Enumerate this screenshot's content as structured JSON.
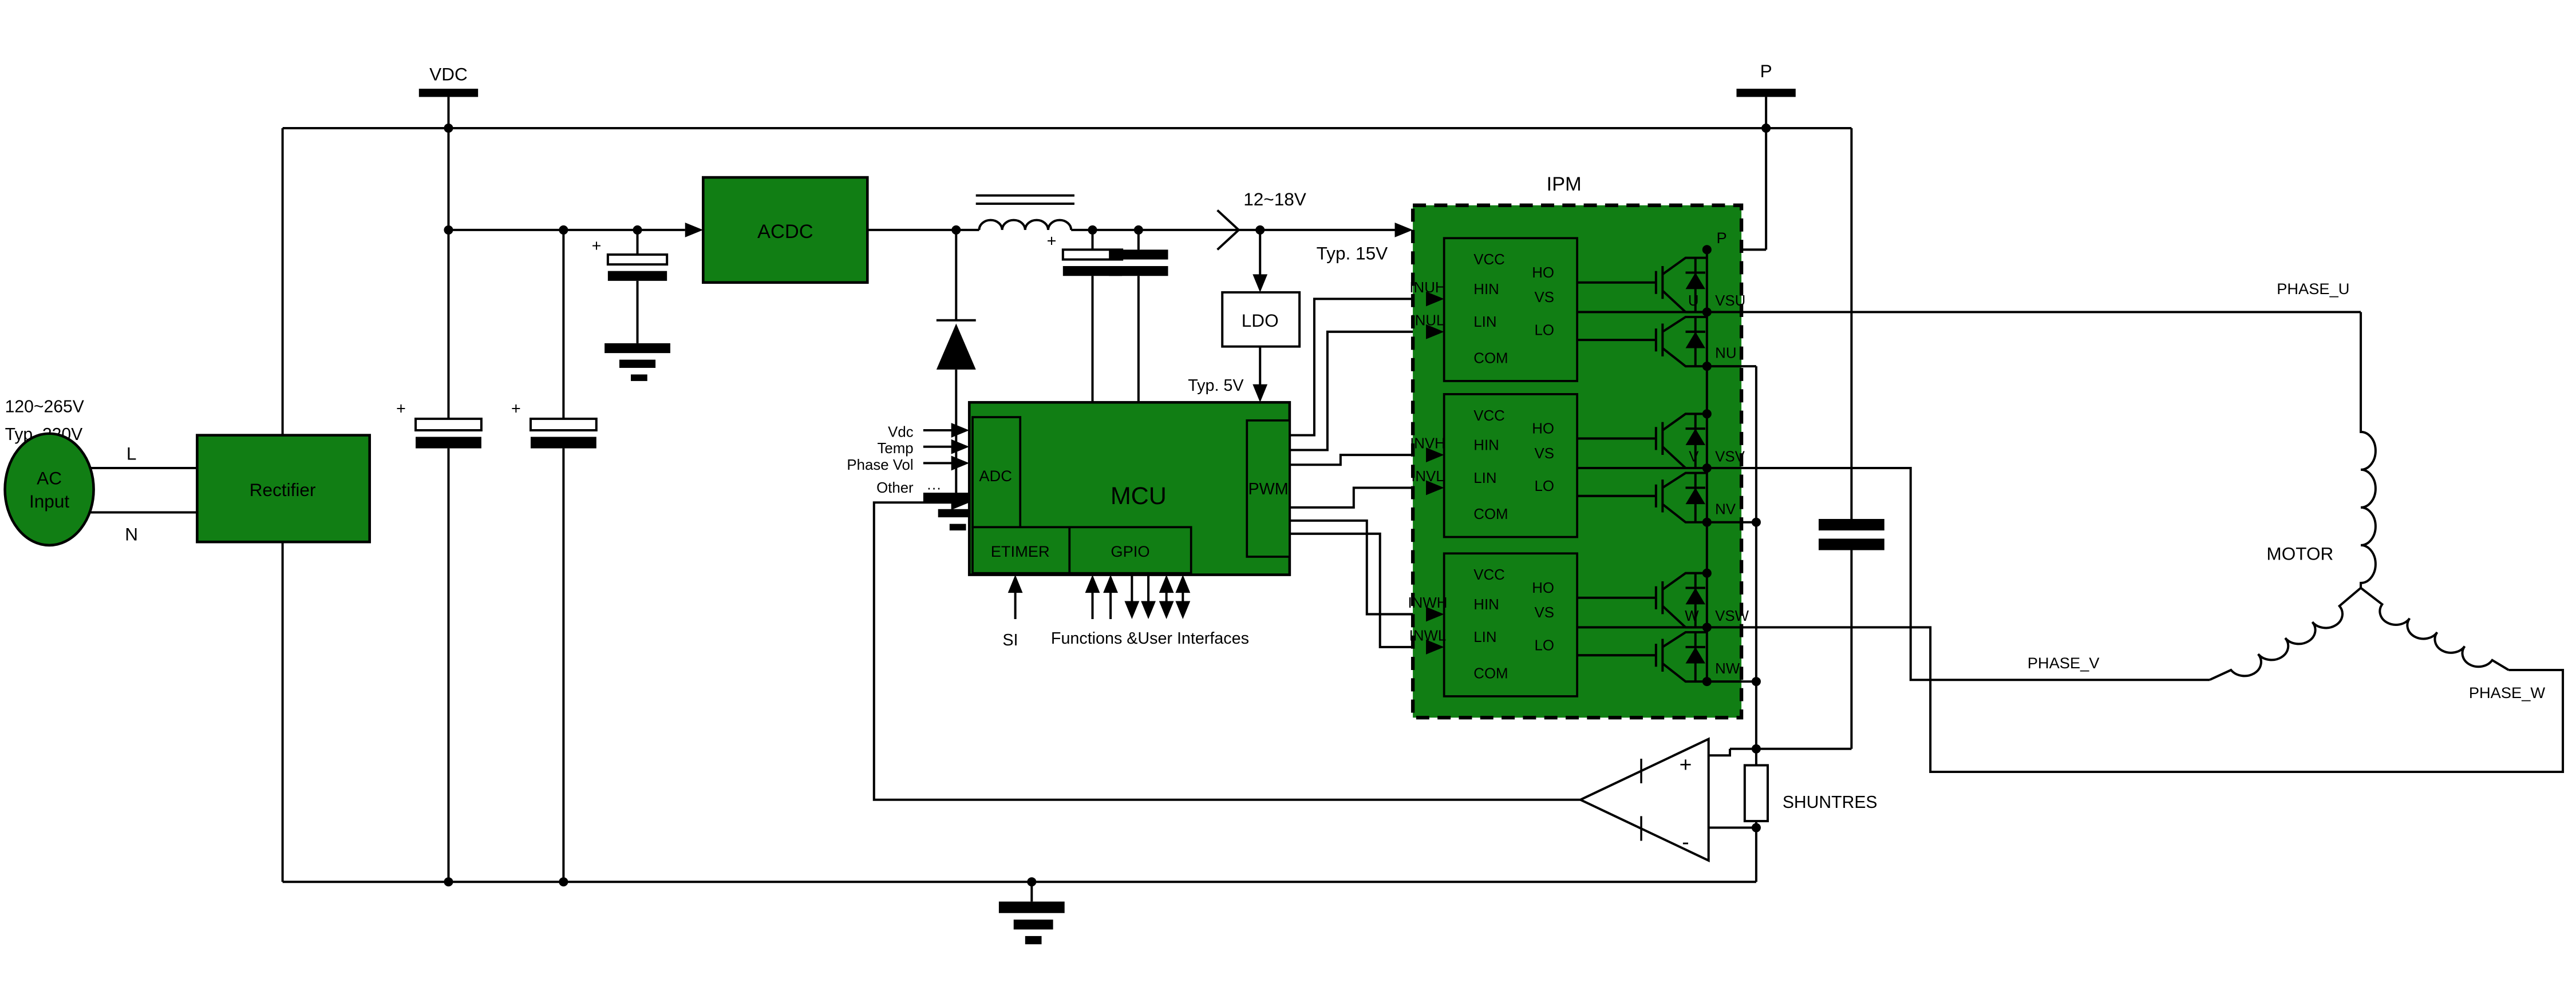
{
  "colors": {
    "block-green": "#117E14",
    "wire": "#000000",
    "bg": "#ffffff"
  },
  "terminals": {
    "vdc": "VDC",
    "p": "P"
  },
  "source": {
    "range": "120~265V",
    "typical": "Typ. 220V",
    "name_line1": "AC",
    "name_line2": "Input",
    "live": "L",
    "neutral": "N"
  },
  "blocks": {
    "rectifier": "Rectifier",
    "acdc": "ACDC",
    "ldo": "LDO",
    "mcu": "MCU",
    "adc": "ADC",
    "pwm": "PWM",
    "etimer": "ETIMER",
    "gpio": "GPIO",
    "ipm": "IPM",
    "motor": "MOTOR"
  },
  "rails": {
    "bus_12_18": "12~18V",
    "typ_15": "Typ. 15V",
    "typ_5": "Typ. 5V"
  },
  "mcu_inputs": {
    "vdc": "Vdc",
    "temp": "Temp",
    "phase_vol": "Phase Vol",
    "other": "Other",
    "ellipsis": "···"
  },
  "mcu_bottom": {
    "si": "SI",
    "functions": "Functions &User Interfaces"
  },
  "ipm": {
    "p_node": "P",
    "drivers": [
      {
        "in_h": "INUH",
        "in_l": "INUL",
        "vcc": "VCC",
        "hin": "HIN",
        "lin": "LIN",
        "com": "COM",
        "ho": "HO",
        "vs": "VS",
        "lo": "LO",
        "phase": "U",
        "vs_node": "VSU",
        "n_node": "NU"
      },
      {
        "in_h": "INVH",
        "in_l": "INVL",
        "vcc": "VCC",
        "hin": "HIN",
        "lin": "LIN",
        "com": "COM",
        "ho": "HO",
        "vs": "VS",
        "lo": "LO",
        "phase": "V",
        "vs_node": "VSV",
        "n_node": "NV"
      },
      {
        "in_h": "INWH",
        "in_l": "INWL",
        "vcc": "VCC",
        "hin": "HIN",
        "lin": "LIN",
        "com": "COM",
        "ho": "HO",
        "vs": "VS",
        "lo": "LO",
        "phase": "W",
        "vs_node": "VSW",
        "n_node": "NW"
      }
    ]
  },
  "outputs": {
    "phase_u": "PHASE_U",
    "phase_v": "PHASE_V",
    "phase_w": "PHASE_W"
  },
  "sense": {
    "shunt": "SHUNTRES",
    "opamp_plus": "+",
    "opamp_minus": "-"
  },
  "symbols": {
    "cap_plus": "+"
  }
}
